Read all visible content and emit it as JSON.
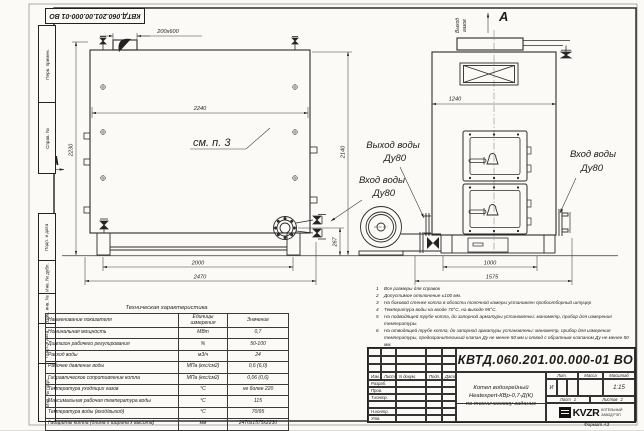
{
  "top_stamp": {
    "designation": "КВТД.060.201.00.000-01 ВО"
  },
  "frame_margin": {
    "labels": [
      "Перв. примен.",
      "Справ. №",
      "Подп. и дата",
      "Инв. № дубл.",
      "Взам. инв. №",
      "Подп. и дата",
      "Инв. № подл."
    ]
  },
  "views": {
    "section_label_left": "А",
    "view_label_top": "А",
    "gas_outlet_line1": "Выход",
    "gas_outlet_line2": "газов",
    "see_note_label": "см. п. 3",
    "water_outlet_line1": "Выход воды",
    "water_outlet_line2": "Ду80",
    "water_inlet_left_line1": "Вход воды",
    "water_inlet_left_line2": "Ду80",
    "water_inlet_right_line1": "Вход воды",
    "water_inlet_right_line2": "Ду80",
    "dims": {
      "duct": "200x600",
      "side_width": "2240",
      "side_height": "2230",
      "front_height": "2140",
      "flange_height": "267",
      "side_base": "2000",
      "side_overall": "2470",
      "front_width": "1240",
      "front_base": "1000",
      "front_overall": "1575"
    }
  },
  "spec_table": {
    "title": "Техническая характеристика",
    "headers": [
      "Наименование показателя",
      "Единицы измерения",
      "Значение"
    ],
    "rows": [
      [
        "Номинальная мощность",
        "МВт",
        "0,7"
      ],
      [
        "Диапазон рабочего регулирования",
        "%",
        "50-100"
      ],
      [
        "Расход воды",
        "м3/ч",
        "24"
      ],
      [
        "Рабочее давление воды",
        "МПа (кгс/см2)",
        "0,6 (6,0)"
      ],
      [
        "Гидравлическое сопротивление котла",
        "МПа (кгс/см2)",
        "0,06 (0,6)"
      ],
      [
        "Температура уходящих газов",
        "°С",
        "не более 220"
      ],
      [
        "Максимальная рабочая температура воды",
        "°С",
        "115"
      ],
      [
        "Температура воды (вход/выход)",
        "°С",
        "70/95"
      ],
      [
        "Габариты котла (длина х ширина х высота)",
        "мм",
        "2470х1575х2230"
      ]
    ]
  },
  "notes": {
    "items": [
      "Все размеры для справок",
      "Допустимое отклонение ±100 мм.",
      "На боковой стенке котла в области топочной камеры установлен пробоотборный штуцер",
      "Температура воды на входе 70°С, на выходе 95°С.",
      "На подводящей трубе котла, до запорной арматуры установлены: манометр, прибор для измерения температуры.",
      "На отводящей трубе котла, до запорной арматуры установлены: манометр, прибор для измерения температуры, предохранительный клапан Ду не менее 50 мм и отвод с обратным клапаном Ду не менее 50 мм.",
      "Остальные технические требования по ОСТ 108.030.133-84"
    ]
  },
  "title_block": {
    "designation": "КВТД.060.201.00.000-01 ВО",
    "name_lines": [
      "Котел водогрейный",
      "Heatexpert-КВр-0,7-Д(К)",
      "по техническому задание"
    ],
    "header_cols": [
      "Изм.",
      "Лист",
      "N докум.",
      "Подп.",
      "Дата"
    ],
    "role_rows": [
      "Разраб.",
      "Пров.",
      "Т.контр.",
      "",
      "Н.контр.",
      "Утв."
    ],
    "lit_label": "Лит.",
    "mass_label": "Масса",
    "scale_label": "Масштаб",
    "lit_value": "И",
    "scale_value": "1:15",
    "sheet_label": "Лист",
    "sheet_value": "1",
    "sheets_label": "Листов",
    "sheets_value": "2",
    "logo_text": "KVZR",
    "logo_sub_lines": [
      "КОТЕЛЬНЫЙ",
      "ЗАВОД РЭП"
    ],
    "format_label": "Формат А3"
  }
}
